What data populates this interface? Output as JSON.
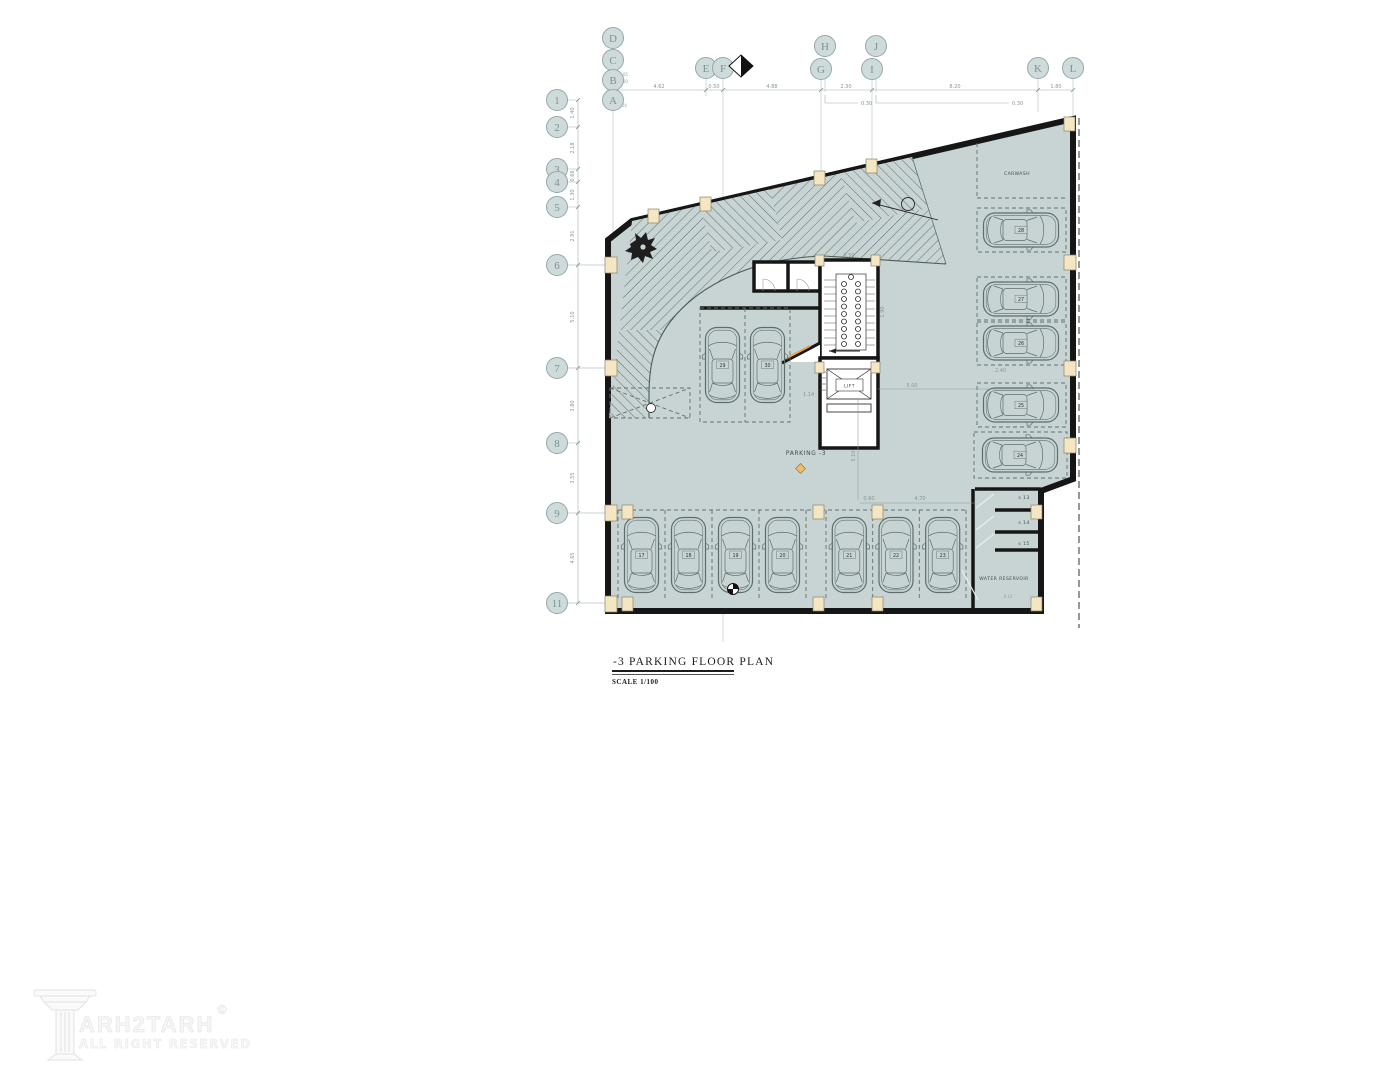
{
  "title": {
    "name": "-3  PARKING  FLOOR PLAN",
    "scale": "SCALE  1/100"
  },
  "watermark": {
    "brand": "ARH2TARH",
    "copyright": "©",
    "tagline": "ALL RIGHT RESERVED"
  },
  "labels": {
    "parking_area": "PARKING -3",
    "carwash": "CARWASH",
    "water_reservoir": "WATER RESERVOIR",
    "lift": "LIFT",
    "storage_1": "s 13",
    "storage_2": "s 14",
    "storage_3": "s 15"
  },
  "grid": {
    "top": [
      "D",
      "C",
      "B",
      "A",
      "E",
      "F",
      "G",
      "H",
      "I",
      "J",
      "K",
      "L"
    ],
    "left": [
      "1",
      "2",
      "3",
      "4",
      "5",
      "6",
      "7",
      "8",
      "9",
      "11"
    ]
  },
  "dims": {
    "top": [
      "4.62",
      "0.50",
      "4.88",
      "2.30",
      "8.20",
      "1.80"
    ],
    "top_offset_1": "0.30",
    "top_offset_2": "0.30",
    "level_1": "0.05",
    "level_2": "0.00",
    "level_3": "4.04",
    "left": [
      "1.40",
      "2.18",
      "0.66",
      "1.30",
      "2.91",
      "5.10",
      "3.80",
      "3.55",
      "4.65"
    ],
    "stair_width": "2.50",
    "stair_side": "1.90",
    "lobby_width": "1.14",
    "hall_width": "5.00",
    "hall_height": "5.10",
    "spot_gap": "2.40",
    "bottom_a": "0.60",
    "bottom_b": "4.70",
    "reservoir_width": "8.10"
  },
  "parking_spots": {
    "bottom": [
      "17",
      "18",
      "19",
      "20",
      "21",
      "22",
      "23"
    ],
    "right": [
      "28",
      "27",
      "26",
      "25",
      "24"
    ],
    "middle": [
      "29",
      "30"
    ]
  },
  "colors": {
    "floor": "#c8d4d3",
    "wall": "#161616",
    "column": "#f4e6c2",
    "door_accent": "#e8a050"
  }
}
